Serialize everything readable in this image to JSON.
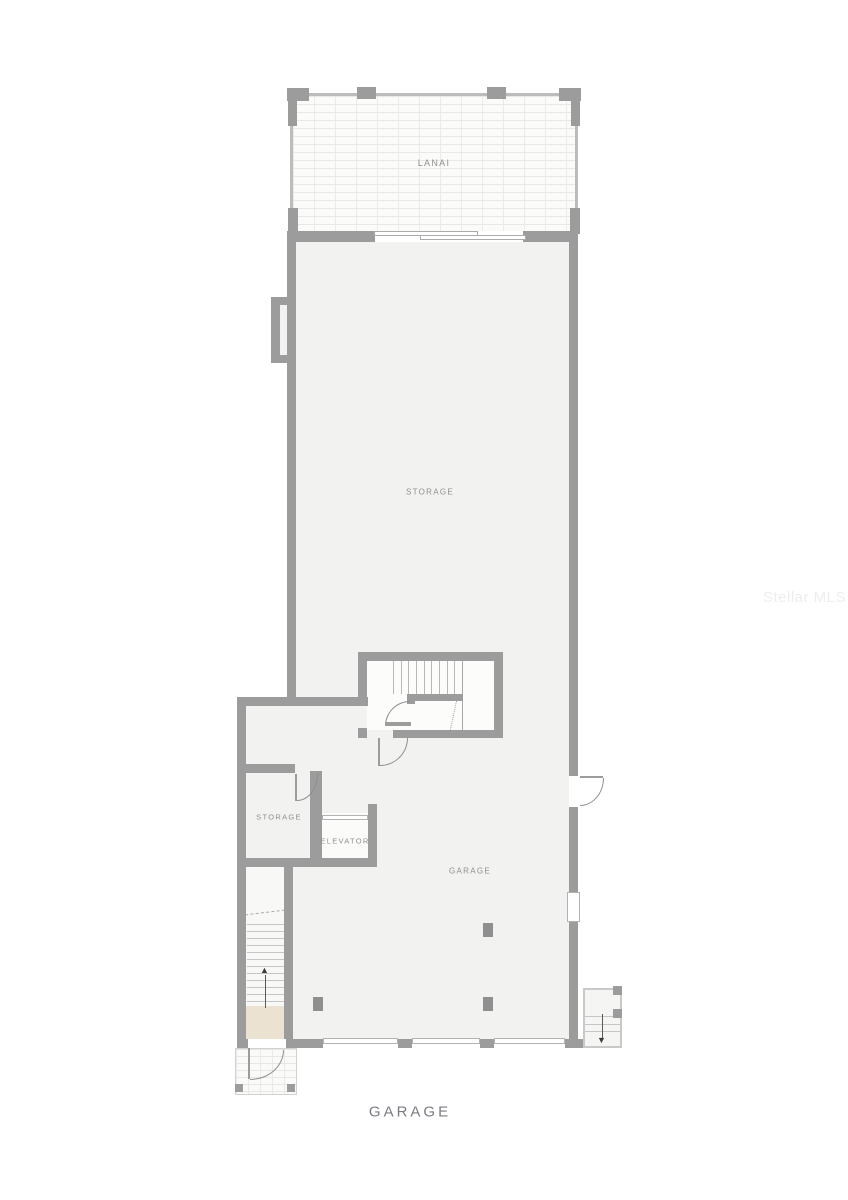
{
  "plan": {
    "title": "GARAGE",
    "watermark": "Stellar MLS",
    "rooms": {
      "lanai": {
        "label": "LANAI"
      },
      "storage_main": {
        "label": "STORAGE"
      },
      "storage_small": {
        "label": "STORAGE"
      },
      "elevator": {
        "label": "ELEVATOR"
      },
      "garage": {
        "label": "GARAGE"
      }
    },
    "stairs": {
      "up_arrow": "▲",
      "down_arrow": "▼"
    },
    "colors": {
      "wall": "#9c9c9c",
      "floor": "#f2f2f0",
      "landing": "#ebe2d2",
      "label_text": "#8f8f8f",
      "title_text": "#7b7b83"
    }
  }
}
